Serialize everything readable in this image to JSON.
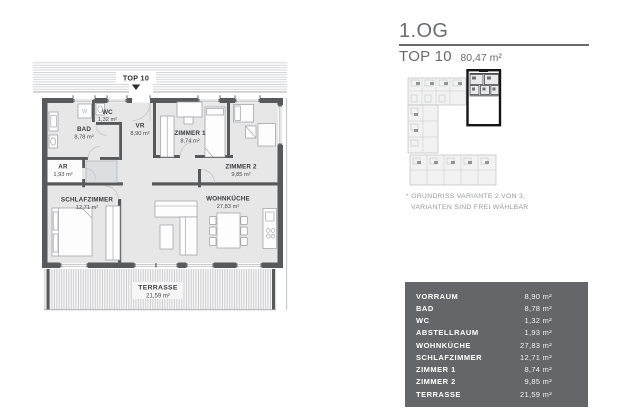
{
  "header": {
    "floor": "1.OG",
    "unit": "TOP 10",
    "area": "80,47 m²"
  },
  "note": {
    "line1": "* GRUNDRISS VARIANTE 2 VON 3,",
    "line2": "VARIANTEN SIND FREI WÄHLBAR"
  },
  "floorplan": {
    "marker": "TOP 10",
    "washer_label": "W",
    "rooms": {
      "wc": {
        "name": "WC",
        "area": "1,32 m²"
      },
      "vr": {
        "name": "VR",
        "area": "8,90 m²"
      },
      "bad": {
        "name": "BAD",
        "area": "8,78 m²"
      },
      "ar": {
        "name": "AR",
        "area": "1,93 m²"
      },
      "zimmer1": {
        "name": "ZIMMER 1",
        "area": "8,74 m²"
      },
      "zimmer2": {
        "name": "ZIMMER 2",
        "area": "9,85 m²"
      },
      "schlafzimmer": {
        "name": "SCHLAFZIMMER",
        "area": "12,71 m²"
      },
      "wohnkueche": {
        "name": "WOHNKÜCHE",
        "area": "27,83 m²"
      },
      "terrasse": {
        "name": "TERRASSE",
        "area": "21,59 m²"
      }
    }
  },
  "area_table": {
    "rows": [
      {
        "label": "VORRAUM",
        "value": "8,90 m²"
      },
      {
        "label": "BAD",
        "value": "8,78 m²"
      },
      {
        "label": "WC",
        "value": "1,32 m²"
      },
      {
        "label": "ABSTELLRAUM",
        "value": "1,93 m²"
      },
      {
        "label": "WOHNKÜCHE",
        "value": "27,83 m²"
      },
      {
        "label": "SCHLAFZIMMER",
        "value": "12,71 m²"
      },
      {
        "label": "ZIMMER 1",
        "value": "8,74 m²"
      },
      {
        "label": "ZIMMER 2",
        "value": "9,85 m²"
      },
      {
        "label": "TERRASSE",
        "value": "21,59 m²"
      }
    ]
  },
  "colors": {
    "wall": "#58595b",
    "room_fill": "#e7e7e8",
    "table_bg": "#646669",
    "title_gray": "#6b6c6e",
    "highlight_border": "#151515"
  }
}
